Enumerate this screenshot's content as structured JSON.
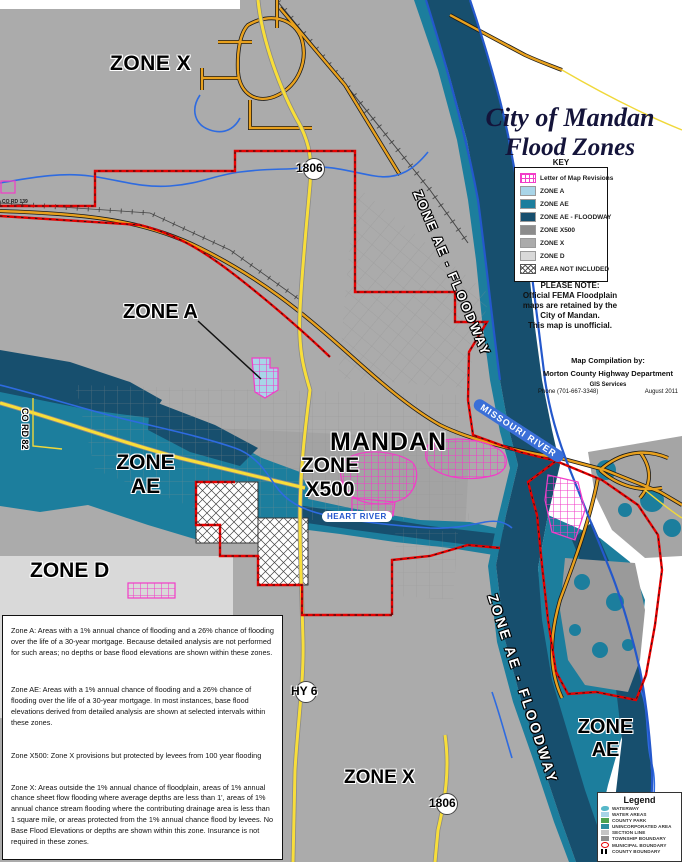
{
  "title": {
    "line1": "City of Mandan",
    "line2": "Flood Zones"
  },
  "key": {
    "heading": "KEY",
    "items": [
      {
        "label": "Letter of Map Revisions",
        "color": "#F23CC8",
        "swatch": "lomr"
      },
      {
        "label": "ZONE A",
        "color": "#A9D5E8",
        "swatch": "fill"
      },
      {
        "label": "ZONE AE",
        "color": "#1C7E9D",
        "swatch": "fill"
      },
      {
        "label": "ZONE AE - FLOODWAY",
        "color": "#174F6E",
        "swatch": "fill"
      },
      {
        "label": "ZONE X500",
        "color": "#8C8C8C",
        "swatch": "fill"
      },
      {
        "label": "ZONE X",
        "color": "#ABABAB",
        "swatch": "fill"
      },
      {
        "label": "ZONE D",
        "color": "#D9D9D9",
        "swatch": "fill"
      },
      {
        "label": "AREA NOT INCLUDED",
        "color": "#FFFFFF",
        "swatch": "hatch"
      }
    ]
  },
  "note": {
    "l1": "PLEASE NOTE:",
    "l2": "Official FEMA Floodplain",
    "l3": "maps are retained by the",
    "l4": "City of Mandan.",
    "l5": "This map is unofficial."
  },
  "credits": {
    "l1": "Map Compilation by:",
    "l2": "Morton County Highway Department",
    "l3": "GIS Services",
    "phone": "Phone (701-667-3348)",
    "date": "August 2011"
  },
  "zones": {
    "zone_x_top": "ZONE X",
    "zone_a": "ZONE A",
    "mandan": "MANDAN",
    "zone_x500_l1": "ZONE",
    "zone_x500_l2": "X500",
    "zone_ae_l1": "ZONE",
    "zone_ae_l2": "AE",
    "zone_d": "ZONE D",
    "zone_x_bottom": "ZONE X",
    "zone_ae_right_l1": "ZONE",
    "zone_ae_right_l2": "AE",
    "floodway": "ZONE AE - FLOODWAY",
    "missouri_river": "MISSOURI RIVER",
    "heart_river": "HEART RIVER"
  },
  "roads": {
    "r1806": "1806",
    "hy6": "HY 6",
    "co_rd_82": "CO RD 82",
    "co_rd_139": "CO RD 139"
  },
  "descriptions": {
    "zone_a": "Zone A:    Areas with a 1% annual chance of flooding and a 26% chance of flooding over the life of a 30-year mortgage. Because detailed analysis are not performed for such areas; no depths or base flood elevations are shown within these zones.",
    "zone_ae": "Zone AE:    Areas with a 1% annual chance of flooding and a 26% chance of flooding over the life of a 30-year mortgage. In most instances, base flood elevations derived from detailed analysis are shown at selected intervals within these zones.",
    "zone_x500": "Zone X500:    Zone X  provisions but protected by levees from 100 year flooding",
    "zone_x": "Zone X:    Areas outside the 1% annual chance of floodplain, areas of 1% annual chance sheet flow flooding where average depths are less than 1', areas of 1% annual chance stream flooding where the contributing drainage area is less than 1 square mile, or areas protected from the 1% annual chance flood by levees. No Base Flood Elevations or depths are shown within this zone. Insurance is not required in these zones.",
    "zone_d": "Zone D:    Areas with possible but undetermined flood hazards. No flood hazard analysis has been conducted. Flood insurance rates are commensurate with the uncertainty of the flood risk."
  },
  "legend": {
    "heading": "Legend",
    "items": [
      {
        "label": "WATERWAY",
        "color": "#57B8C9"
      },
      {
        "label": "WATER AREAS",
        "color": "#A8D4E6"
      },
      {
        "label": "COUNTY PARK",
        "color": "#4EA24E"
      },
      {
        "label": "UNINCORPORATED AREA",
        "color": "#2E8EA0"
      },
      {
        "label": "SECTION LINE",
        "color": "#C4C4C4"
      },
      {
        "label": "TOWNSHIP BOUNDARY",
        "color": "#8E8E8E"
      },
      {
        "label": "MUNICIPAL BOUNDARY",
        "color": "#E60000"
      },
      {
        "label": "COUNTY BOUNDARY",
        "color": "#000000"
      }
    ]
  },
  "colors": {
    "floodway": "#174F6E",
    "zone_ae": "#1C7E9D",
    "zone_a": "#A9D5E8",
    "zone_x": "#ABABAB",
    "zone_x500": "#9E9E9E",
    "zone_d": "#D9D9D9",
    "lomr_magenta": "#F23CC8",
    "road_orange": "#E8A11E",
    "road_yellow": "#F8DE3A",
    "stream_blue": "#2E6BE0",
    "municipal_red": "#E60000",
    "river_label_blue": "#3A6FD7"
  }
}
